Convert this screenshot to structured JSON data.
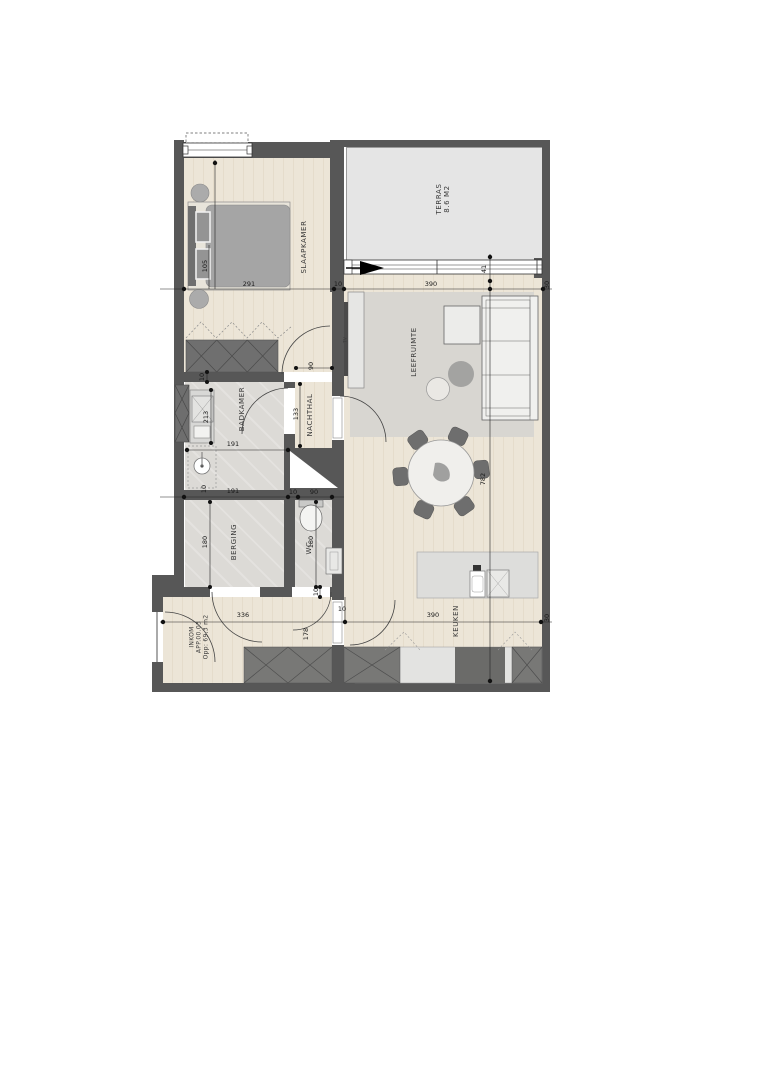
{
  "title": "Floor plan apartment APP.00.03",
  "rooms": {
    "slaapkamer": "SLAAPKAMER",
    "terras_name": "TERRAS",
    "terras_area": "8.6 M2",
    "leefruimte": "LEEFRUIMTE",
    "tv": "TV",
    "badkamer": "BADKAMER",
    "nachthal": "NACHTHAL",
    "berging": "BERGING",
    "wc": "WC",
    "keuken": "KEUKEN",
    "inkom_name": "INKOM",
    "inkom_unit": "APP.00.03",
    "inkom_area": "Opp: 69,3 m2"
  },
  "dims": {
    "d291": "291",
    "d10a": "10",
    "d390a": "390",
    "d30a": "30",
    "d105": "105",
    "d41": "41",
    "d782": "782",
    "d191a": "191",
    "d213": "213",
    "d10b": "10",
    "d191b": "191",
    "d10c": "10",
    "d133": "133",
    "d90a": "90",
    "d180a": "180",
    "d180b": "180",
    "d90b": "90",
    "d10d": "10",
    "d10e": "10",
    "d336": "336",
    "d178": "178",
    "d10f": "10",
    "d390b": "390",
    "d30b": "30"
  },
  "colors": {
    "wall": "#575757",
    "wood_floor": "#ebe3d5",
    "tile_floor": "#dcdad6",
    "terrace_floor": "#e5e5e5",
    "rug": "#d8d6d1",
    "furniture_gray": "#a5a5a5",
    "cabinet_dark": "#787876",
    "line": "#1a1a1a"
  }
}
